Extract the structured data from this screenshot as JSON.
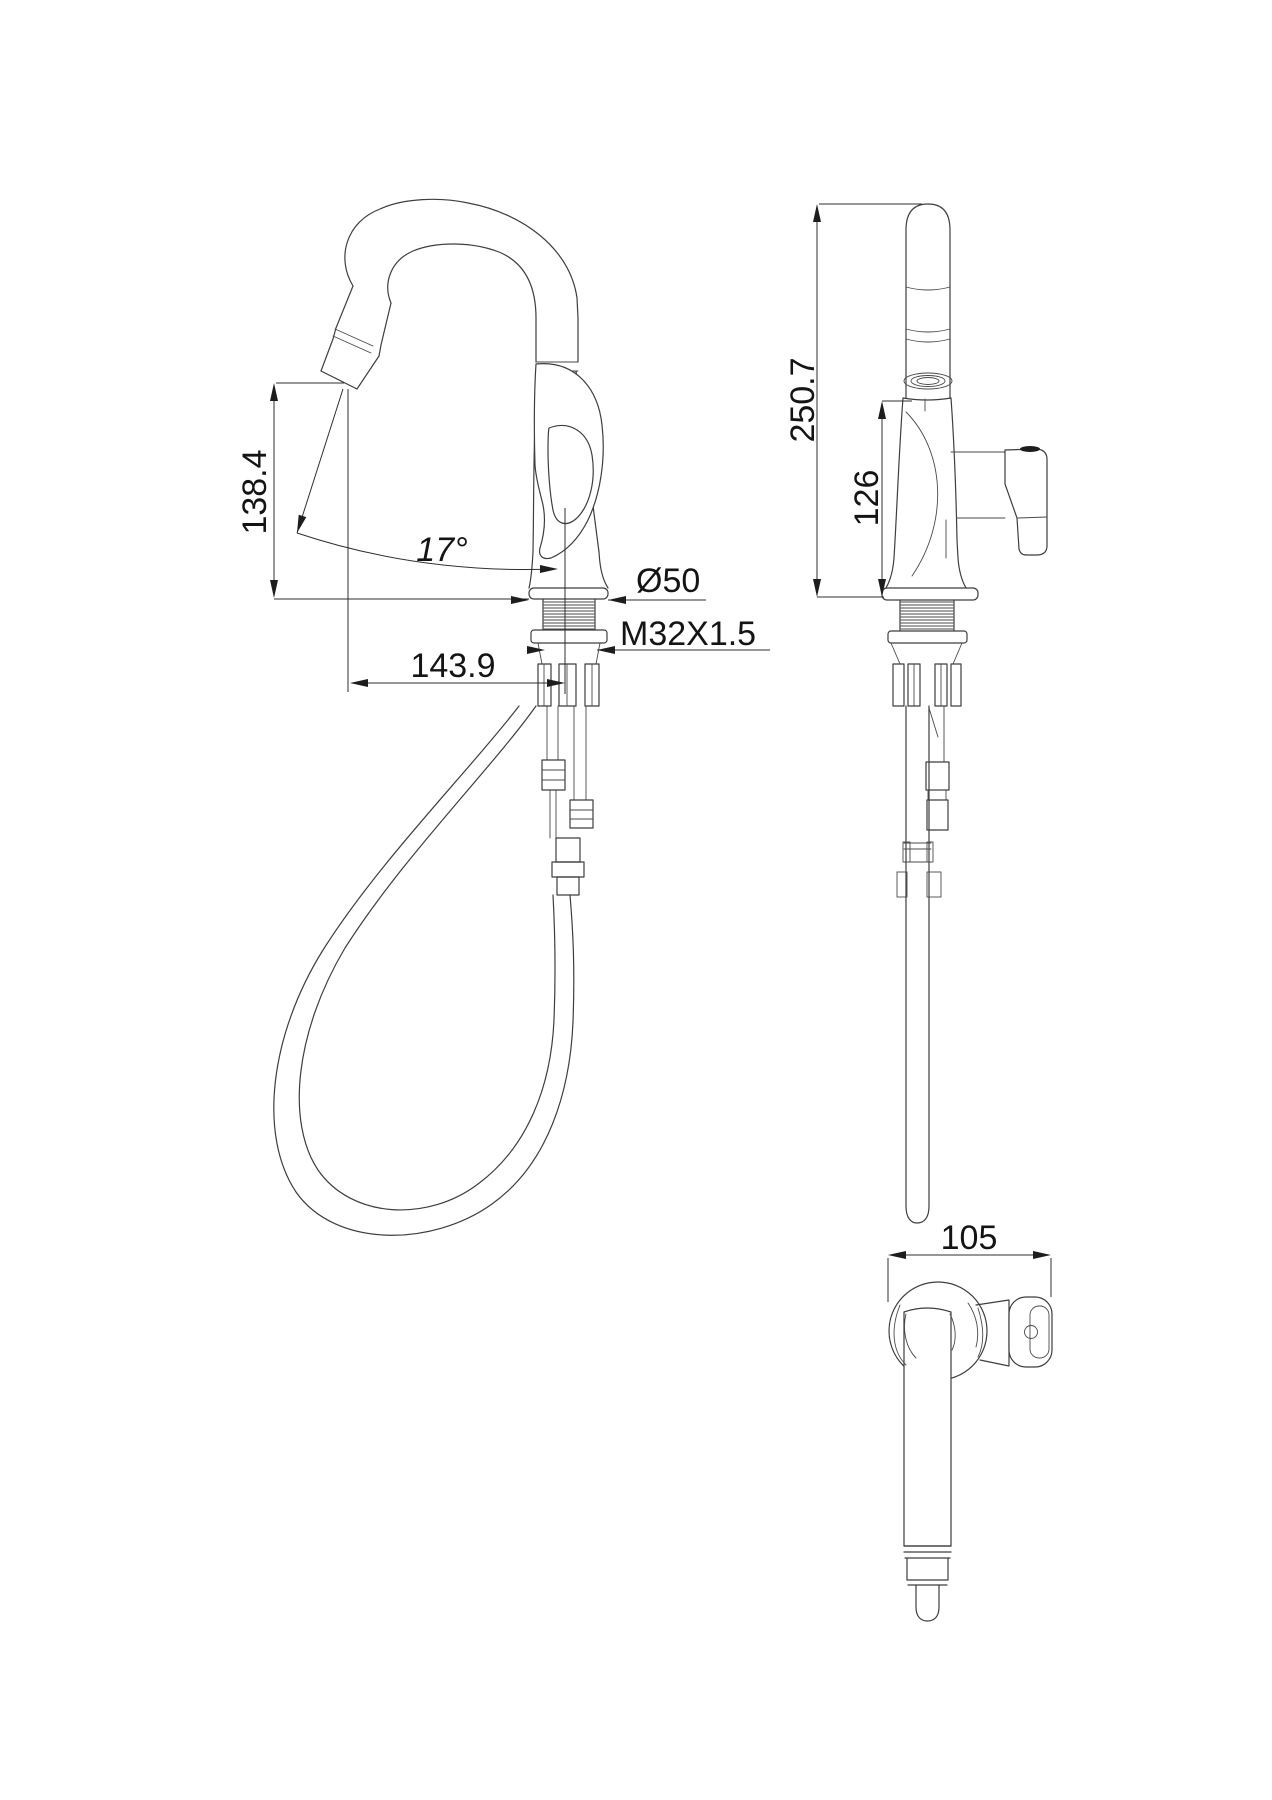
{
  "drawing": {
    "type": "kitchen-faucet-dimension-drawing",
    "views": [
      "side-view",
      "front-view",
      "top-view"
    ],
    "line_color": "#3e3e3e",
    "background": "#ffffff"
  },
  "dimensions": {
    "spout_tip_height": "138.4",
    "spray_head_angle": "17°",
    "escutcheon_diameter": "Ø50",
    "mounting_thread": "M32X1.5",
    "spout_reach": "143.9",
    "overall_height": "250.7",
    "body_height": "126",
    "handle_depth": "105"
  }
}
